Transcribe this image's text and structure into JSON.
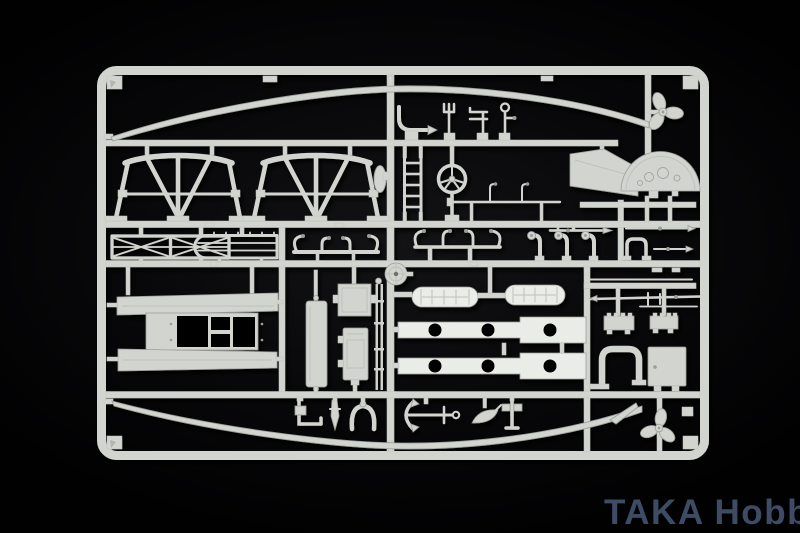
{
  "image": {
    "description": "Photograph of a light-grey injection-molded model kit sprue (ship detail parts tree) on a black background",
    "width": 800,
    "height": 533
  },
  "colors": {
    "background": "#010102",
    "background-center": "#131315",
    "sprue-light": "#e4e6e2",
    "sprue-bright": "#eaece8",
    "sprue-mid": "#d2d4d0",
    "sprue-dark": "#bfc1bd",
    "sprue-shadow": "#9b9d99",
    "hole": "#050505",
    "watermark": "#42506b"
  },
  "watermark": {
    "text": "TAKA Hobby"
  },
  "sprue": {
    "frame": "rounded rectangular runner frame with corner gussets",
    "parts": [
      {
        "id": "sheer-rail-upper",
        "label": "long curved hull sheer rail (top)"
      },
      {
        "id": "keel-rail-lower",
        "label": "long curved hull keel rail (bottom)"
      },
      {
        "id": "boat-cradle-a",
        "label": "trestle boat cradle stand"
      },
      {
        "id": "boat-cradle-b",
        "label": "trestle boat cradle stand"
      },
      {
        "id": "fairlead-oval",
        "label": "oval fairlead disc"
      },
      {
        "id": "curved-pipe",
        "label": "curved pipe fitting with arrow tip"
      },
      {
        "id": "trident-finial",
        "label": "trident mast finial"
      },
      {
        "id": "bracket-fitting",
        "label": "double-bar bracket fitting"
      },
      {
        "id": "stanchion-loop",
        "label": "stanchion with loop head"
      },
      {
        "id": "ladder",
        "label": "accommodation ladder"
      },
      {
        "id": "ships-wheel",
        "label": "ship's wheel on pedestal"
      },
      {
        "id": "awning-stanchions",
        "label": "rod with awning stanchions"
      },
      {
        "id": "windbreak-panel",
        "label": "slanted windbreak panel"
      },
      {
        "id": "propeller-upper",
        "label": "three-blade propeller"
      },
      {
        "id": "bridge-dome",
        "label": "semicircular bridge face with fittings"
      },
      {
        "id": "crossbrace-railing",
        "label": "cross-braced railing section"
      },
      {
        "id": "deck-railing",
        "label": "multi-rail deck railing with bend"
      },
      {
        "id": "boat-chock-a",
        "label": "boat chock frame"
      },
      {
        "id": "boat-chock-b",
        "label": "boat chock frame"
      },
      {
        "id": "boat-hook",
        "label": "boat hook / jack staff"
      },
      {
        "id": "cowl-vents",
        "label": "three cowl ventilators"
      },
      {
        "id": "u-pipe-small",
        "label": "small U pipe"
      },
      {
        "id": "arrow-rods",
        "label": "pointed rigging rods"
      },
      {
        "id": "boom-rods",
        "label": "boom and yard rods"
      },
      {
        "id": "skylight-a",
        "label": "ridged skylight box"
      },
      {
        "id": "skylight-b",
        "label": "ridged skylight box"
      },
      {
        "id": "exhaust-u-pipe",
        "label": "large U exhaust pipe"
      },
      {
        "id": "hatch-panel",
        "label": "square hatch panel"
      },
      {
        "id": "deck-platform",
        "label": "large deck platform with openings"
      },
      {
        "id": "side-panel",
        "label": "tall narrow side panel"
      },
      {
        "id": "cabin-box-a",
        "label": "cabin box"
      },
      {
        "id": "cabin-box-b",
        "label": "winch housing box"
      },
      {
        "id": "mast-rods",
        "label": "pair of thin mast rods"
      },
      {
        "id": "cable-reel",
        "label": "spoked cable reel"
      },
      {
        "id": "liferaft-a",
        "label": "rolled liferaft float"
      },
      {
        "id": "liferaft-b",
        "label": "rolled liferaft float"
      },
      {
        "id": "porthole-strip-a",
        "label": "stepped strip with porthole openings"
      },
      {
        "id": "porthole-strip-b",
        "label": "stepped strip with porthole openings"
      },
      {
        "id": "angle-bracket",
        "label": "L angle bracket"
      },
      {
        "id": "rudder-blade",
        "label": "small rudder blade"
      },
      {
        "id": "wishbone-frame",
        "label": "wishbone frame"
      },
      {
        "id": "anchor",
        "label": "stocked anchor"
      },
      {
        "id": "blade-spare",
        "label": "spare propeller blade"
      },
      {
        "id": "t-bracket",
        "label": "T bracket post"
      },
      {
        "id": "skeg-sliver",
        "label": "tapered skeg sliver"
      },
      {
        "id": "propeller-lower",
        "label": "three-blade propeller"
      }
    ]
  }
}
